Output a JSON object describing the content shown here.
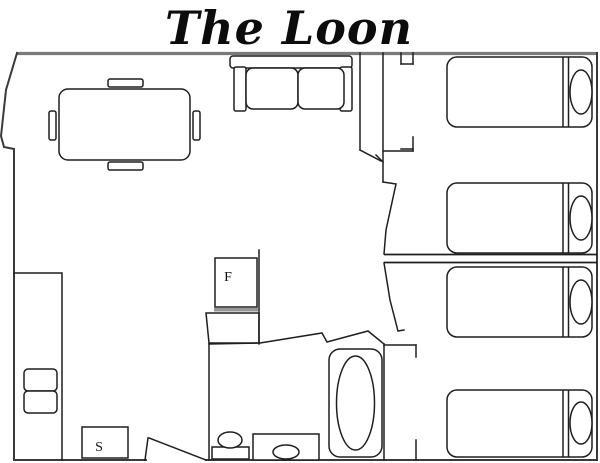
{
  "title": "The Loon",
  "floorplan": {
    "fridge_label": "F",
    "stove_label": "S"
  },
  "colors": {
    "line": "#1f1f1f",
    "outer-wall": "#3a3a3a",
    "top-wall": "#7a7a7a",
    "shadow": "#979797",
    "background": "#ffffff"
  }
}
